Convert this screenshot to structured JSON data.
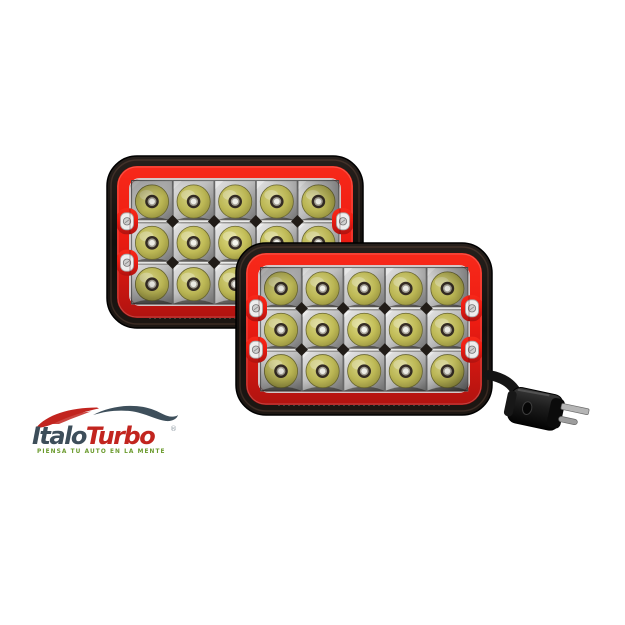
{
  "canvas": {
    "background": "#ffffff",
    "width": 625,
    "height": 625
  },
  "product": {
    "description": "Pair of rectangular 4x6 sealed-beam LED headlights with red bezels, chrome reflector grid of 15 LED lenses each, black housings, and one 3-prong sealed-beam plug",
    "headlights": [
      {
        "id": "rear",
        "led_rows": 3,
        "led_columns": 5,
        "led_count": 15,
        "has_plug": false
      },
      {
        "id": "front",
        "led_rows": 3,
        "led_columns": 5,
        "led_count": 15,
        "has_plug": true
      }
    ],
    "plug": {
      "type": "3-prong sealed beam connector",
      "prongs": 3
    }
  },
  "logo": {
    "brand_part1": "Italo",
    "brand_part2": "Turbo",
    "registered": "®",
    "tagline": "PIENSA TU AUTO EN LA MENTE"
  },
  "colors": {
    "canvas-bg": "#ffffff",
    "frame-black": "#14100e",
    "bezel-red": "#ee1c12",
    "bezel-red-bright": "#f7291a",
    "bezel-red-dark": "#b01310",
    "chrome-light": "#f0f0f0",
    "chrome-mid": "#c9c9c9",
    "chrome-dark": "#757575",
    "lens-olive": "#c4bf58",
    "lens-olive-dark": "#938e3c",
    "lens-olive-pale": "#e0dd8b",
    "led-ring-dark": "#362d25",
    "led-ring-metal": "#aaa69b",
    "led-center-white": "#f6f6ef",
    "diamond-dark": "#221d18",
    "screw-silver": "#cfcfcf",
    "cord-black": "#141414",
    "plug-body": "#1d1d1d",
    "prong-silver": "#b5b5b5",
    "logo-slate": "#3d4e5a",
    "logo-red": "#c2251f",
    "logo-green": "#6b9b2e",
    "car-red": "#c2241f",
    "car-slate": "#3e4f5b"
  }
}
